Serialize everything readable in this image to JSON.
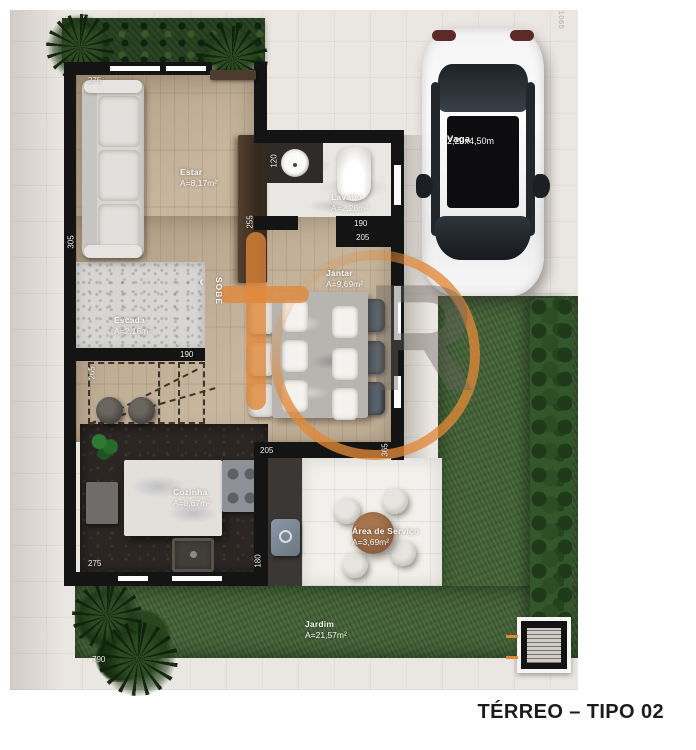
{
  "title": "TÉRREO – TIPO 02",
  "plan_name": "Floor plan – ground floor type 02",
  "rooms": {
    "estar": {
      "name": "Estar",
      "area": "A=8,17m²"
    },
    "lavabo": {
      "name": "Lavabo",
      "area": "A=2,28m²"
    },
    "jantar": {
      "name": "Jantar",
      "area": "A=9,69m²"
    },
    "escada": {
      "name": "Escada",
      "area": "A=2,16m²"
    },
    "cozinha": {
      "name": "Cozinha",
      "area": "A=8,67m²"
    },
    "servico": {
      "name": "Área de Serviço",
      "area": "A=3,69m²"
    },
    "jardim": {
      "name": "Jardim",
      "area": "A=21,57m²"
    }
  },
  "parking": {
    "name": "Vaga",
    "size": "2,20x4,50m"
  },
  "stairs": {
    "direction_label": "SOBE",
    "arrow": "‹"
  },
  "dimensions": {
    "estar_top": "275",
    "estar_left": "305",
    "estar_right": "255",
    "lavabo_left": "120",
    "lavabo_bottom": "190",
    "jantar_top": "205",
    "jantar_bottom": "205",
    "jantar_right": "365",
    "stairs_width": "190",
    "stairs_left": "265",
    "cozinha_bottom": "275",
    "cozinha_right": "180",
    "jardim_left": "790",
    "lot_right": "1065"
  },
  "watermark": {
    "letters": "R"
  },
  "colors": {
    "wall": "#141414",
    "accent_orange": "#e0883c",
    "lawn_green": "#47663b",
    "hedge_green": "#2a4423",
    "wood_floor": "#c3b096"
  }
}
